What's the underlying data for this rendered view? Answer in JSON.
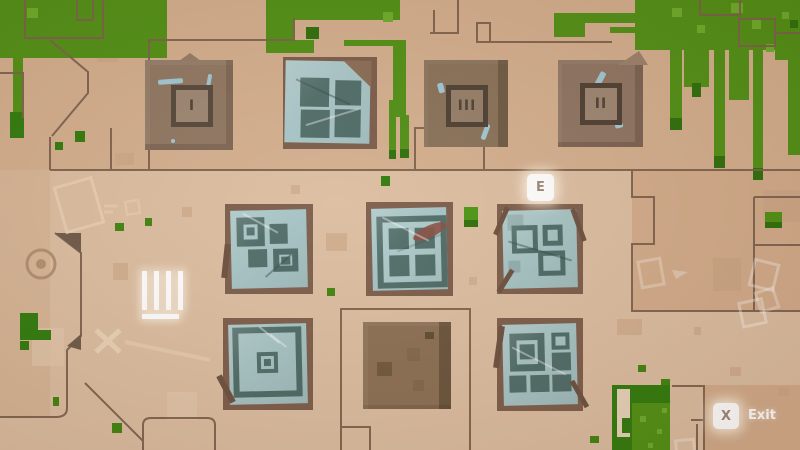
{
  "hud": {
    "interact_prompt": {
      "key": "E"
    },
    "exit_prompt": {
      "key": "X",
      "label": "Exit"
    },
    "tally": {
      "count": 4
    }
  },
  "tiles": {
    "top_row": [
      {
        "type": "numbered-shrine",
        "numeral": "I"
      },
      {
        "type": "window-panel"
      },
      {
        "type": "numbered-shrine",
        "numeral": "III"
      },
      {
        "type": "numbered-shrine",
        "numeral": "II"
      }
    ],
    "middle_row": [
      {
        "type": "panel-squares"
      },
      {
        "type": "panel-large-window"
      },
      {
        "type": "panel-outlined-squares"
      }
    ],
    "bottom_row": [
      {
        "type": "panel-target"
      },
      {
        "type": "plain-brown"
      },
      {
        "type": "panel-mixed-squares"
      }
    ]
  },
  "colors": {
    "ground": "#dcbda0",
    "ground_dark": "#d3ae8d",
    "path_outline": "#7c604b",
    "grass": "#4f8f13",
    "grass_light": "#6cab28",
    "grass_dark": "#2f7a0a",
    "tile_brown": "#8e7560",
    "tile_frame_dark": "#55463a",
    "panel_border_brown": "#7b5c49",
    "panel_blue": "#a6c4c5",
    "panel_square_dark": "#4f6c68",
    "hud_key_bg": "#ffffff",
    "hud_key_text": "#9a887a",
    "hud_text": "#ffffff"
  }
}
